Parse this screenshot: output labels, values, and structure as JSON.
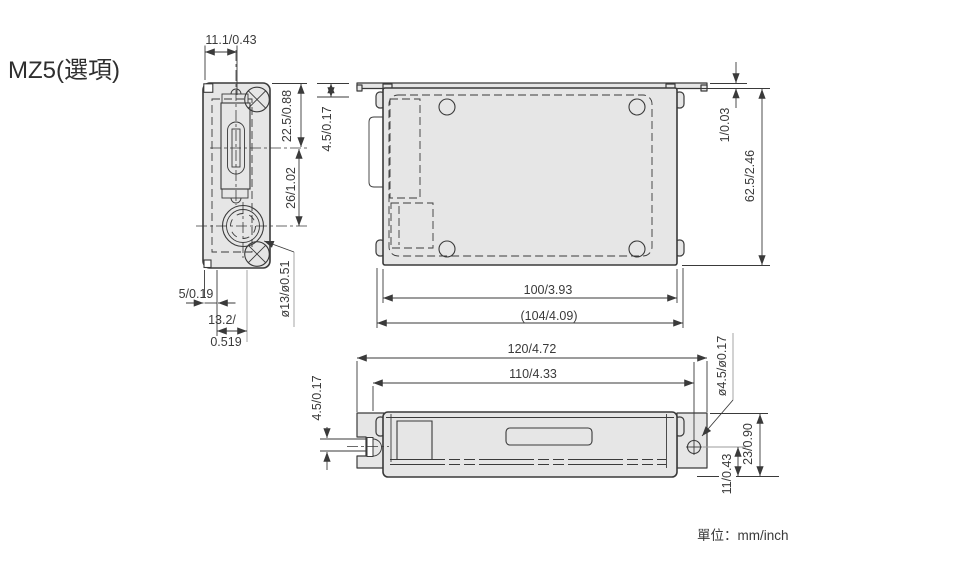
{
  "title": "MZ5(選項)",
  "units_label": "單位：mm/inch",
  "colors": {
    "line": "#3a3a3a",
    "body_fill": "#e6e6e6",
    "thin_rule": "#9b9b9b",
    "background": "#ffffff"
  },
  "side_view": {
    "dims": {
      "width_top": "11.1/0.43",
      "top_to_connector": "22.5/0.88",
      "screw_offset": "4.5/0.17",
      "connector_to_knob": "26/1.02",
      "edge_to_center": "5/0.19",
      "center_spacing_line1": "13.2/",
      "center_spacing_line2": "0.519",
      "knob_diameter": "ø13/ø0.51"
    }
  },
  "top_view": {
    "dims": {
      "flange_thickness": "1/0.03",
      "depth": "62.5/2.46",
      "body_width": "100/3.93",
      "overall_width": "(104/4.09)"
    }
  },
  "front_view": {
    "dims": {
      "bracket_span": "120/4.72",
      "hole_span": "110/4.33",
      "screw_diameter": "4.5/0.17",
      "hole_diameter": "ø4.5/ø0.17",
      "height": "23/0.90",
      "hole_to_bottom": "11/0.43"
    }
  }
}
